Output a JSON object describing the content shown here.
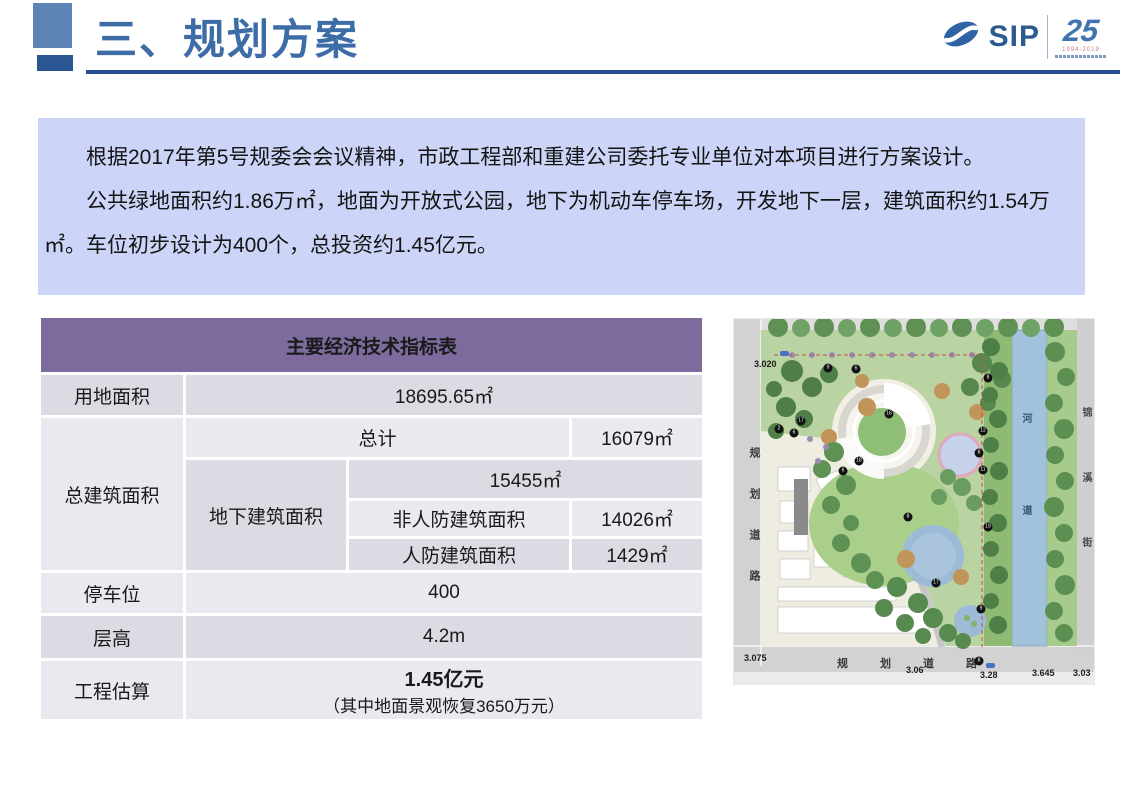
{
  "slide": {
    "title": "三、规划方案"
  },
  "logo": {
    "name": "SIP",
    "anniversary": "25",
    "years": "1994-2019"
  },
  "intro": {
    "p1": "根据2017年第5号规委会会议精神，市政工程部和重建公司委托专业单位对本项目进行方案设计。",
    "p2": "公共绿地面积约1.86万㎡，地面为开放式公园，地下为机动车停车场，开发地下一层，建筑面积约1.54万㎡。车位初步设计为400个，总投资约1.45亿元。"
  },
  "table": {
    "title": "主要经济技术指标表",
    "land_area_label": "用地面积",
    "land_area_value": "18695.65㎡",
    "total_floor_label": "总建筑面积",
    "total_label": "总计",
    "total_value": "16079㎡",
    "underground_label": "地下建筑面积",
    "underground_value": "15455㎡",
    "non_civil_defense_label": "非人防建筑面积",
    "non_civil_defense_value": "14026㎡",
    "civil_defense_label": "人防建筑面积",
    "civil_defense_value": "1429㎡",
    "parking_label": "停车位",
    "parking_value": "400",
    "floor_height_label": "层高",
    "floor_height_value": "4.2m",
    "estimate_label": "工程估算",
    "estimate_value": "1.45亿元",
    "estimate_note": "（其中地面景观恢复3650万元）"
  },
  "site_plan": {
    "road_left": "规划道路",
    "road_bottom": "规划道路",
    "river": "河道",
    "street_right": "锦溪街",
    "elevations": {
      "e1": "3.020",
      "e2": "3.075",
      "e3": "3.06",
      "e4": "3.28",
      "e5": "3.645",
      "e6": "3.03"
    },
    "markers": [
      {
        "n": "9",
        "x": 94,
        "y": 49
      },
      {
        "n": "6",
        "x": 122,
        "y": 50
      },
      {
        "n": "8",
        "x": 254,
        "y": 59
      },
      {
        "n": "17",
        "x": 67,
        "y": 102
      },
      {
        "n": "2",
        "x": 45,
        "y": 110
      },
      {
        "n": "6",
        "x": 60,
        "y": 114
      },
      {
        "n": "16",
        "x": 155,
        "y": 95
      },
      {
        "n": "12",
        "x": 249,
        "y": 112
      },
      {
        "n": "8",
        "x": 245,
        "y": 134
      },
      {
        "n": "11",
        "x": 249,
        "y": 151
      },
      {
        "n": "18",
        "x": 125,
        "y": 142
      },
      {
        "n": "6",
        "x": 109,
        "y": 152
      },
      {
        "n": "8",
        "x": 174,
        "y": 198
      },
      {
        "n": "19",
        "x": 254,
        "y": 208
      },
      {
        "n": "17",
        "x": 202,
        "y": 264
      },
      {
        "n": "9",
        "x": 247,
        "y": 290
      },
      {
        "n": "8",
        "x": 245,
        "y": 342
      }
    ]
  },
  "colors": {
    "title_blue": "#3D6CA6",
    "rule_navy": "#24508F",
    "intro_bg": "#CCD5F8",
    "table_header_purple": "#7D6B9E",
    "cell_dark": "#DCDAE2",
    "cell_light": "#EAE9EF",
    "river_blue": "#A2C1DA",
    "park_green": "#BAD3A2"
  }
}
